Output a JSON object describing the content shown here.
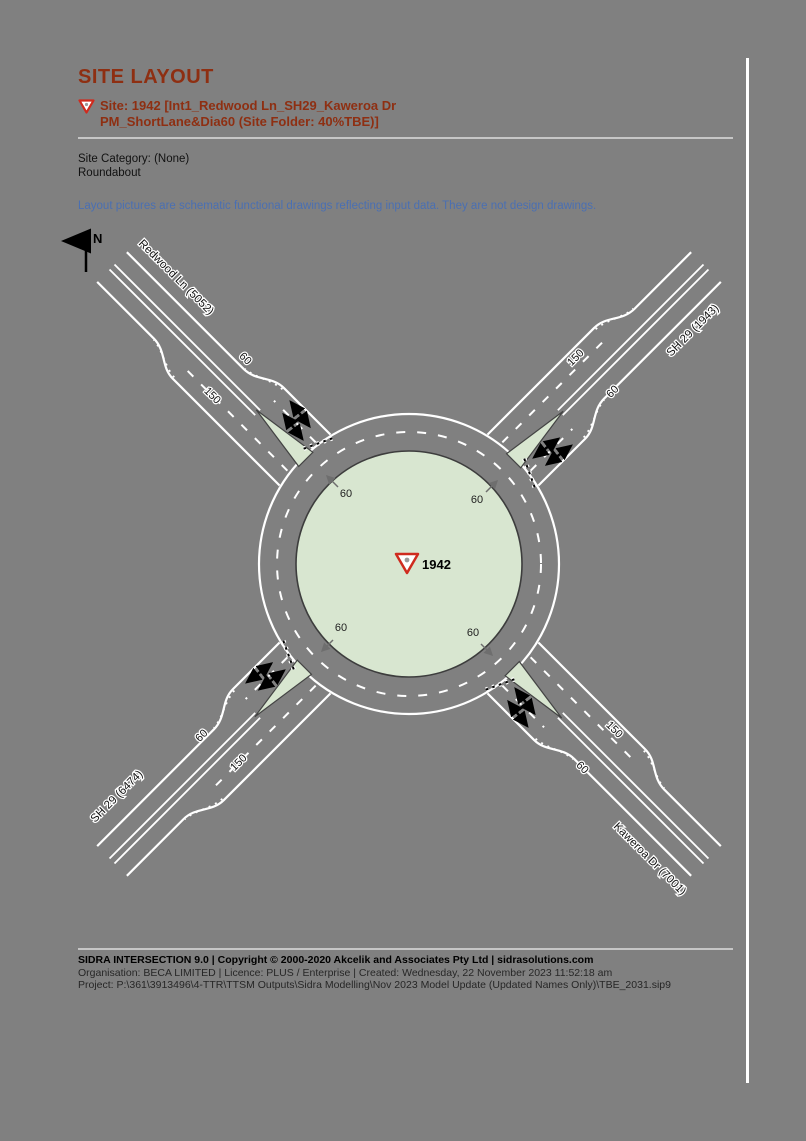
{
  "page": {
    "title": "SITE LAYOUT",
    "site_line1": "Site: 1942 [Int1_Redwood Ln_SH29_Kaweroa Dr",
    "site_line2": "PM_ShortLane&Dia60 (Site Folder: 40%TBE)]",
    "category_label": "Site Category: (None)",
    "control_type": "Roundabout",
    "note": "Layout pictures are schematic functional drawings reflecting input data. They are not design drawings."
  },
  "diagram": {
    "north_label": "N",
    "site_id": "1942",
    "island_speeds": {
      "nw": "60",
      "ne": "60",
      "sw": "60",
      "se": "60"
    },
    "legs": {
      "nw": {
        "name": "Redwood Ln (5052)",
        "entry_lane_len": "60",
        "exit_lane_len": "150"
      },
      "ne": {
        "name": "SH 29 (1943)",
        "entry_lane_len": "60",
        "exit_lane_len": "150"
      },
      "sw": {
        "name": "SH 29 (6474)",
        "entry_lane_len": "60",
        "exit_lane_len": "150"
      },
      "se": {
        "name": "Kaweroa Dr (7001)",
        "entry_lane_len": "60",
        "exit_lane_len": "150"
      }
    }
  },
  "footer": {
    "line1": "SIDRA INTERSECTION 9.0  |  Copyright © 2000-2020 Akcelik and Associates Pty Ltd  |  sidrasolutions.com",
    "line2": "Organisation: BECA LIMITED  |  Licence: PLUS / Enterprise  |  Created: Wednesday, 22 November 2023 11:52:18 am",
    "line3": "Project: P:\\361\\3913496\\4-TTR\\TTSM Outputs\\Sidra Modelling\\Nov 2023 Model Update (Updated Names Only)\\TBE_2031.sip9"
  },
  "colors": {
    "background_gray": "#808080",
    "accent_red": "#8e2f12",
    "note_blue": "#4a6fb2",
    "island_green": "#d8e6d0",
    "road_marking_white": "#ffffff",
    "giveway_sign_red": "#cf2b1e"
  }
}
